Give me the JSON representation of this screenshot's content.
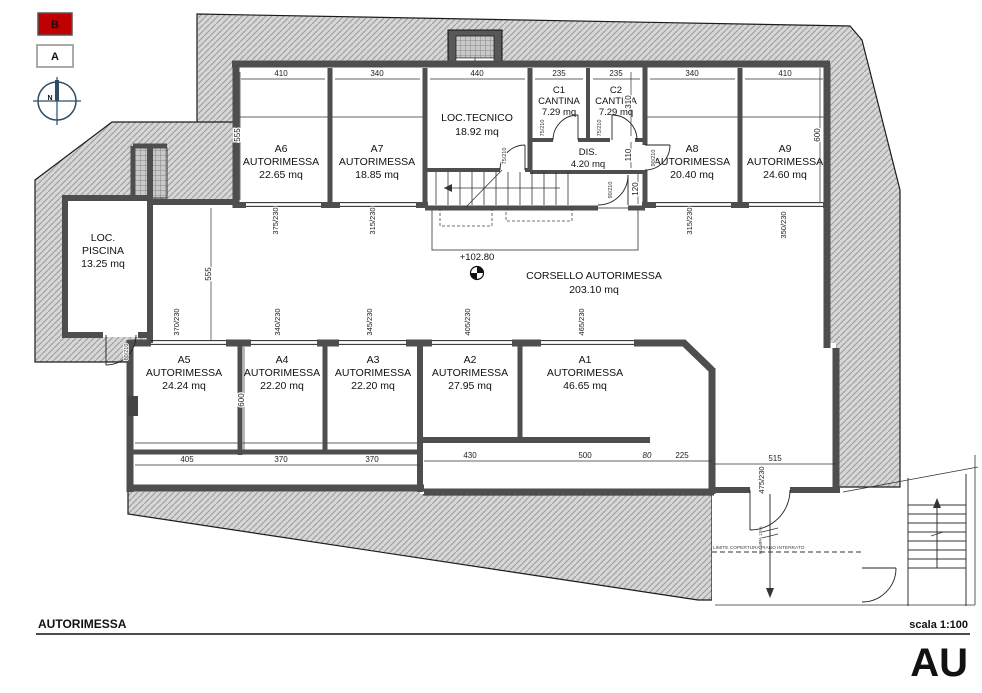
{
  "legend": {
    "marker_b": "B",
    "marker_a": "A",
    "north": "N"
  },
  "colors": {
    "marker_red": "#c00000",
    "wall_gray": "#4e4e4e",
    "earth_hatch": "#d6d6d6",
    "compass_navy": "#2e4d66"
  },
  "rooms": {
    "a6": {
      "id": "A6",
      "type": "AUTORIMESSA",
      "area": "22.65 mq"
    },
    "a7": {
      "id": "A7",
      "type": "AUTORIMESSA",
      "area": "18.85 mq"
    },
    "loc_tecnico": {
      "name": "LOC.TECNICO",
      "area": "18.92 mq"
    },
    "c1": {
      "id": "C1",
      "type": "CANTINA",
      "area": "7.29 mq"
    },
    "c2": {
      "id": "C2",
      "type": "CANTINA",
      "area": "7.29 mq"
    },
    "dis": {
      "name": "DIS.",
      "area": "4.20 mq"
    },
    "a8": {
      "id": "A8",
      "type": "AUTORIMESSA",
      "area": "20.40 mq"
    },
    "a9": {
      "id": "A9",
      "type": "AUTORIMESSA",
      "area": "24.60 mq"
    },
    "piscina": {
      "name1": "LOC.",
      "name2": "PISCINA",
      "area": "13.25 mq"
    },
    "corsello": {
      "name": "CORSELLO AUTORIMESSA",
      "area": "203.10 mq"
    },
    "a5": {
      "id": "A5",
      "type": "AUTORIMESSA",
      "area": "24.24 mq"
    },
    "a4": {
      "id": "A4",
      "type": "AUTORIMESSA",
      "area": "22.20 mq"
    },
    "a3": {
      "id": "A3",
      "type": "AUTORIMESSA",
      "area": "22.20 mq"
    },
    "a2": {
      "id": "A2",
      "type": "AUTORIMESSA",
      "area": "27.95 mq"
    },
    "a1": {
      "id": "A1",
      "type": "AUTORIMESSA",
      "area": "46.65 mq"
    }
  },
  "level_marker": "+102.80",
  "dims": {
    "top": [
      "410",
      "340",
      "440",
      "235",
      "235",
      "340",
      "410"
    ],
    "doors_top": [
      "375/230",
      "315/230",
      "315/230",
      "350/230"
    ],
    "doors_mid": [
      "370/230",
      "340/230",
      "345/230",
      "405/230",
      "465/230"
    ],
    "bottom": [
      "405",
      "370",
      "370",
      "430",
      "500",
      "80",
      "225",
      "515"
    ],
    "vertical": [
      "555",
      "555",
      "600",
      "600",
      "310",
      "110",
      "120"
    ],
    "ramp_door": "475/230"
  },
  "door_labels": [
    "75/210",
    "75/210",
    "75/210",
    "90/210",
    "90/210",
    "80/210"
  ],
  "annotations": {
    "ramp": "RAMPA 15%",
    "limit": "LIMITE COPERTURA PIANO INTERRATO"
  },
  "titleblock": {
    "title": "AUTORIMESSA",
    "scale": "scala 1:100",
    "code": "AU"
  }
}
